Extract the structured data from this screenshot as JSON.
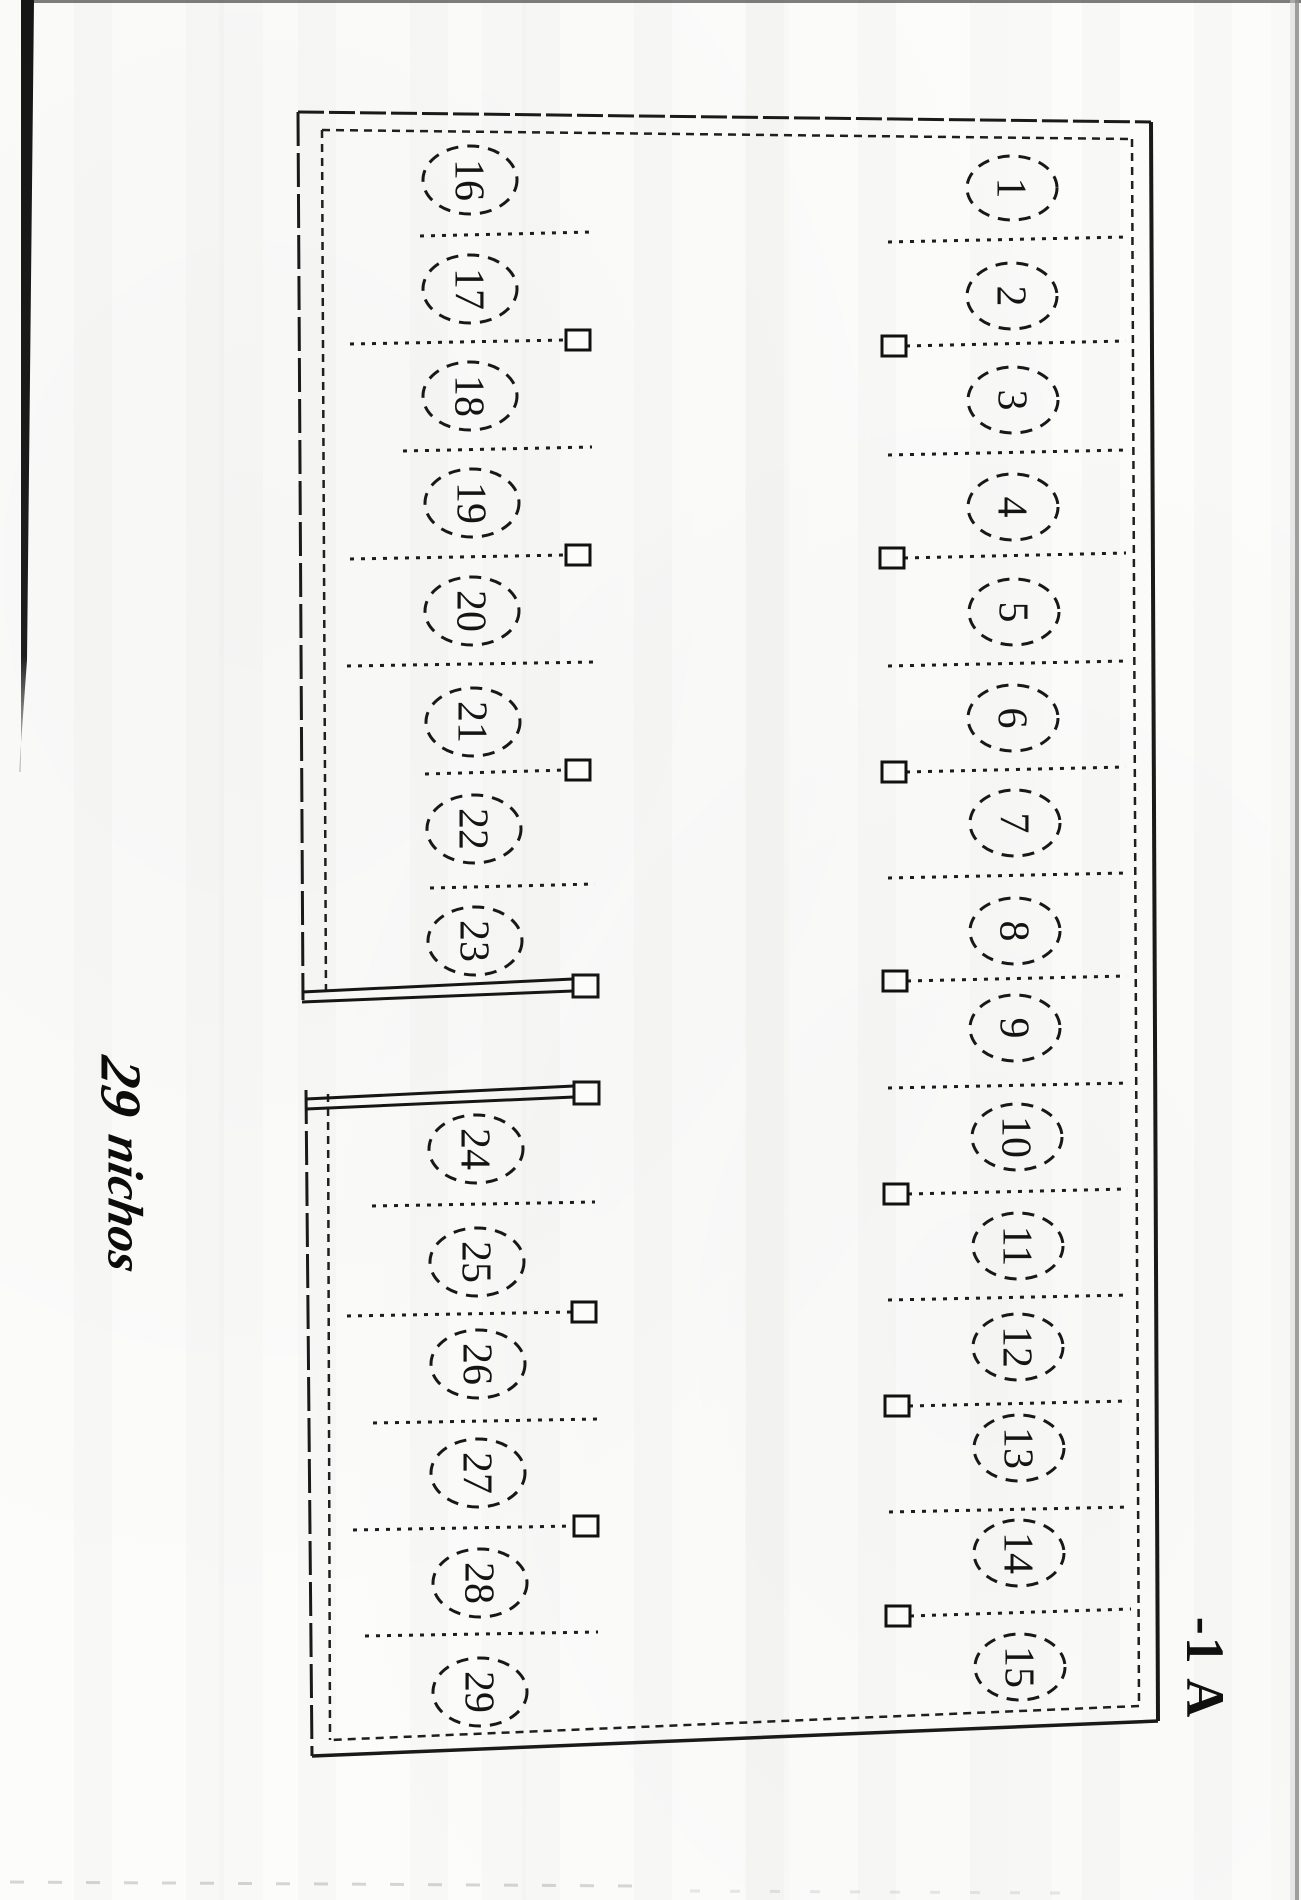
{
  "document": {
    "block_label": "-1 A"
  },
  "handwritten_note": {
    "line1": "29",
    "line2": "nichos"
  },
  "stalls": [
    "1",
    "2",
    "3",
    "4",
    "5",
    "6",
    "7",
    "8",
    "9",
    "10",
    "11",
    "12",
    "13",
    "14",
    "15",
    "16",
    "17",
    "18",
    "19",
    "20",
    "21",
    "22",
    "23",
    "24",
    "25",
    "26",
    "27",
    "28",
    "29"
  ]
}
